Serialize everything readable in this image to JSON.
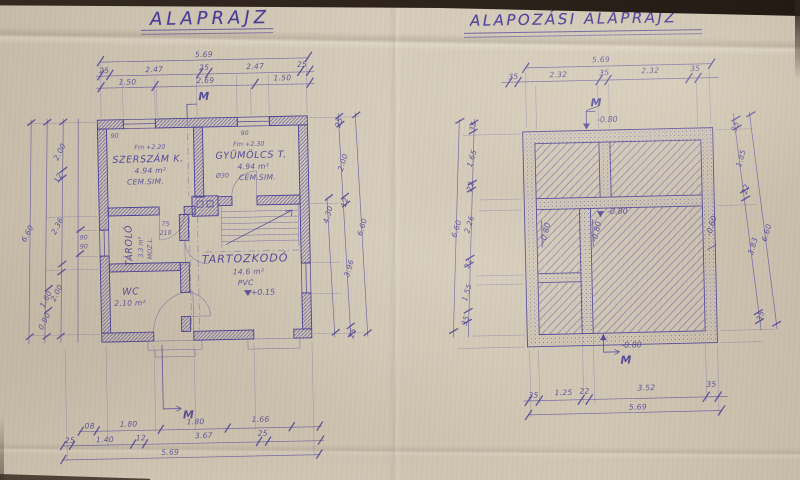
{
  "titles": {
    "left": "ALAPRAJZ",
    "right": "ALAPOZÁSI ALAPRAJZ"
  },
  "floor_plan": {
    "room_szerszam": {
      "mark": "Fm +2.20",
      "name": "SZERSZÁM K.",
      "area": "4.94 m²",
      "floor": "CEM.SIM."
    },
    "room_gyumolcs": {
      "mark": "Fm +2.30",
      "name": "GYÜMÖLCS T.",
      "area": "4.94 m²",
      "floor": "CEM.SIM.",
      "vent": "Ø30"
    },
    "room_tarolo": {
      "name": "TÁROLÓ",
      "area": "3.3 m²",
      "floor": "MOZ.L."
    },
    "room_wc": {
      "name": "WC",
      "area": "2.10 m²"
    },
    "room_tartozkodo": {
      "name": "TARTOZKODÓ",
      "area": "14.6 m²",
      "floor": "PVC"
    },
    "level_entry": "+0.15",
    "door_size_w": "75",
    "door_size_h": "210",
    "window_mark_a": "90",
    "window_mark_b": "90",
    "window_mark_c": "90",
    "window_mark_d": "90",
    "section_mark_top": "M",
    "section_mark_bottom": "M",
    "dims": {
      "top_total": "5.69",
      "top_row": [
        "25",
        "2.47",
        "25",
        "2.47",
        "25"
      ],
      "top_row2": [
        "1.50",
        "2.69",
        "1.50"
      ],
      "bottom_row": [
        "08",
        "1.80",
        "1.80",
        "1.66"
      ],
      "bottom_row2": [
        "25",
        "1.40",
        "12",
        "3.67",
        "25"
      ],
      "bottom_total": "5.69",
      "right_chain": [
        "25",
        "2.00",
        "12",
        "3.96",
        "25"
      ],
      "right_inner": "4.30",
      "right_total": "6.60",
      "left_chain": [
        "2.00",
        "12",
        "2.36",
        "2.00"
      ],
      "left_outer": [
        "1.60",
        "0.90"
      ],
      "left_total": "6.60"
    }
  },
  "foundation_plan": {
    "levels": {
      "top": "-0.80",
      "mid": "-0.80",
      "mid_v": "-0.80",
      "left_room": "-0.80",
      "right_side": "-0.60",
      "bottom": "-0.80"
    },
    "section_mark_top": "M",
    "section_mark_bottom": "M",
    "dims": {
      "top_total": "5.69",
      "top_row": [
        "35",
        "2.32",
        "35",
        "2.32",
        "35"
      ],
      "bottom_row": [
        "35",
        "1.25",
        "22",
        "3.52",
        "35"
      ],
      "bottom_total": "5.69",
      "right_chain": [
        "35",
        "1.85",
        "22",
        "3.83",
        "35"
      ],
      "right_total": "6.60",
      "left_chain": [
        "35",
        "1.65",
        "22",
        "2.26",
        "22",
        "1.55",
        "35"
      ],
      "left_total": "6.60"
    }
  }
}
